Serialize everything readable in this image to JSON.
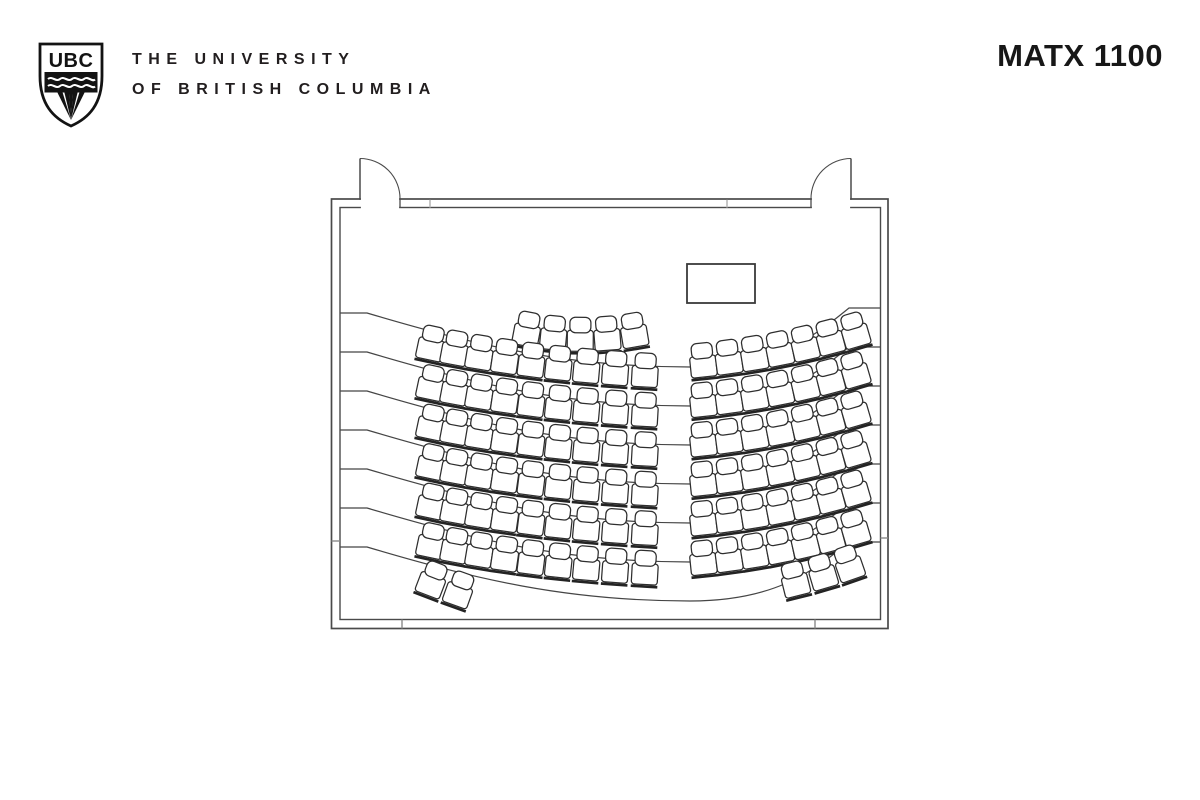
{
  "header": {
    "crest": {
      "label": "UBC"
    },
    "university_name_line1": "THE UNIVERSITY",
    "university_name_line2": "OF BRITISH COLUMBIA",
    "room_label": "MATX 1100"
  },
  "floorplan": {
    "type": "lecture-hall-seating-plan",
    "total_seats": 106,
    "colors": {
      "background": "#ffffff",
      "wall": "#4a4a4a",
      "tier_line": "#454545",
      "seat_stroke": "#2e2e2e",
      "seat_fill": "#ffffff",
      "lectern_stroke": "#3a3a3a",
      "tick_light": "#b9b9b9",
      "tick_dark": "#8a8a8a"
    },
    "room": {
      "outer": {
        "x": 331.5,
        "y": 199,
        "w": 556.5,
        "h": 429.5
      },
      "inner": {
        "x": 340,
        "y": 207.5,
        "w": 540.5,
        "h": 412
      }
    },
    "doors": [
      {
        "side": "top",
        "hinge_x": 360,
        "swing_to_x": 400,
        "leaf_top_y": 158.5,
        "sweep": 1
      },
      {
        "side": "top",
        "hinge_x": 851,
        "swing_to_x": 811,
        "leaf_top_y": 158.5,
        "sweep": 0
      }
    ],
    "lectern": {
      "x": 687,
      "y": 264,
      "w": 68,
      "h": 39
    },
    "tier_lines": {
      "left_wall_y": [
        313,
        352,
        391,
        430,
        469,
        508,
        547
      ],
      "dip": 54,
      "dip_x": 690,
      "right_end_offset": -5
    },
    "seat_rows": [
      {
        "id": "front-center",
        "count": 5,
        "p0": [
          527,
          331
        ],
        "p1": [
          580,
          341
        ],
        "p2": [
          634,
          332
        ]
      },
      {
        "id": "left-row-1",
        "count": 9,
        "p0": [
          431,
          345
        ],
        "p1": [
          525,
          365
        ],
        "p2": [
          645,
          372
        ]
      },
      {
        "id": "left-row-2",
        "count": 9,
        "p0": [
          431,
          384.5
        ],
        "p1": [
          525,
          404.5
        ],
        "p2": [
          645,
          411.5
        ]
      },
      {
        "id": "left-row-3",
        "count": 9,
        "p0": [
          431,
          424
        ],
        "p1": [
          525,
          444
        ],
        "p2": [
          645,
          451
        ]
      },
      {
        "id": "left-row-4",
        "count": 9,
        "p0": [
          431,
          463.5
        ],
        "p1": [
          525,
          483.5
        ],
        "p2": [
          645,
          490.5
        ]
      },
      {
        "id": "left-row-5",
        "count": 9,
        "p0": [
          431,
          503
        ],
        "p1": [
          525,
          523
        ],
        "p2": [
          645,
          530
        ]
      },
      {
        "id": "left-row-6",
        "count": 9,
        "p0": [
          431,
          542.5
        ],
        "p1": [
          525,
          562.5
        ],
        "p2": [
          645,
          569.5
        ]
      },
      {
        "id": "right-row-1",
        "count": 7,
        "p0": [
          703,
          362
        ],
        "p1": [
          780,
          354
        ],
        "p2": [
          855,
          332
        ]
      },
      {
        "id": "right-row-2",
        "count": 7,
        "p0": [
          703,
          401.5
        ],
        "p1": [
          780,
          393.5
        ],
        "p2": [
          855,
          371.5
        ]
      },
      {
        "id": "right-row-3",
        "count": 7,
        "p0": [
          703,
          441
        ],
        "p1": [
          780,
          433
        ],
        "p2": [
          855,
          411
        ]
      },
      {
        "id": "right-row-4",
        "count": 7,
        "p0": [
          703,
          480.5
        ],
        "p1": [
          780,
          472.5
        ],
        "p2": [
          855,
          450.5
        ]
      },
      {
        "id": "right-row-5",
        "count": 7,
        "p0": [
          703,
          520
        ],
        "p1": [
          780,
          512
        ],
        "p2": [
          855,
          490
        ]
      },
      {
        "id": "right-row-6",
        "count": 7,
        "p0": [
          703,
          559.5
        ],
        "p1": [
          780,
          551.5
        ],
        "p2": [
          855,
          529.5
        ]
      },
      {
        "id": "back-left",
        "count": 2,
        "p0": [
          432,
          581
        ],
        "p1": [
          445,
          586
        ],
        "p2": [
          459,
          591
        ]
      },
      {
        "id": "back-right",
        "count": 3,
        "p0": [
          795,
          581
        ],
        "p1": [
          823,
          574
        ],
        "p2": [
          849,
          565
        ]
      }
    ],
    "wall_ticks": {
      "top_x": [
        430,
        727
      ],
      "bottom_x": [
        402,
        815
      ],
      "left_y": [
        541
      ],
      "right_y": [
        538
      ]
    }
  }
}
